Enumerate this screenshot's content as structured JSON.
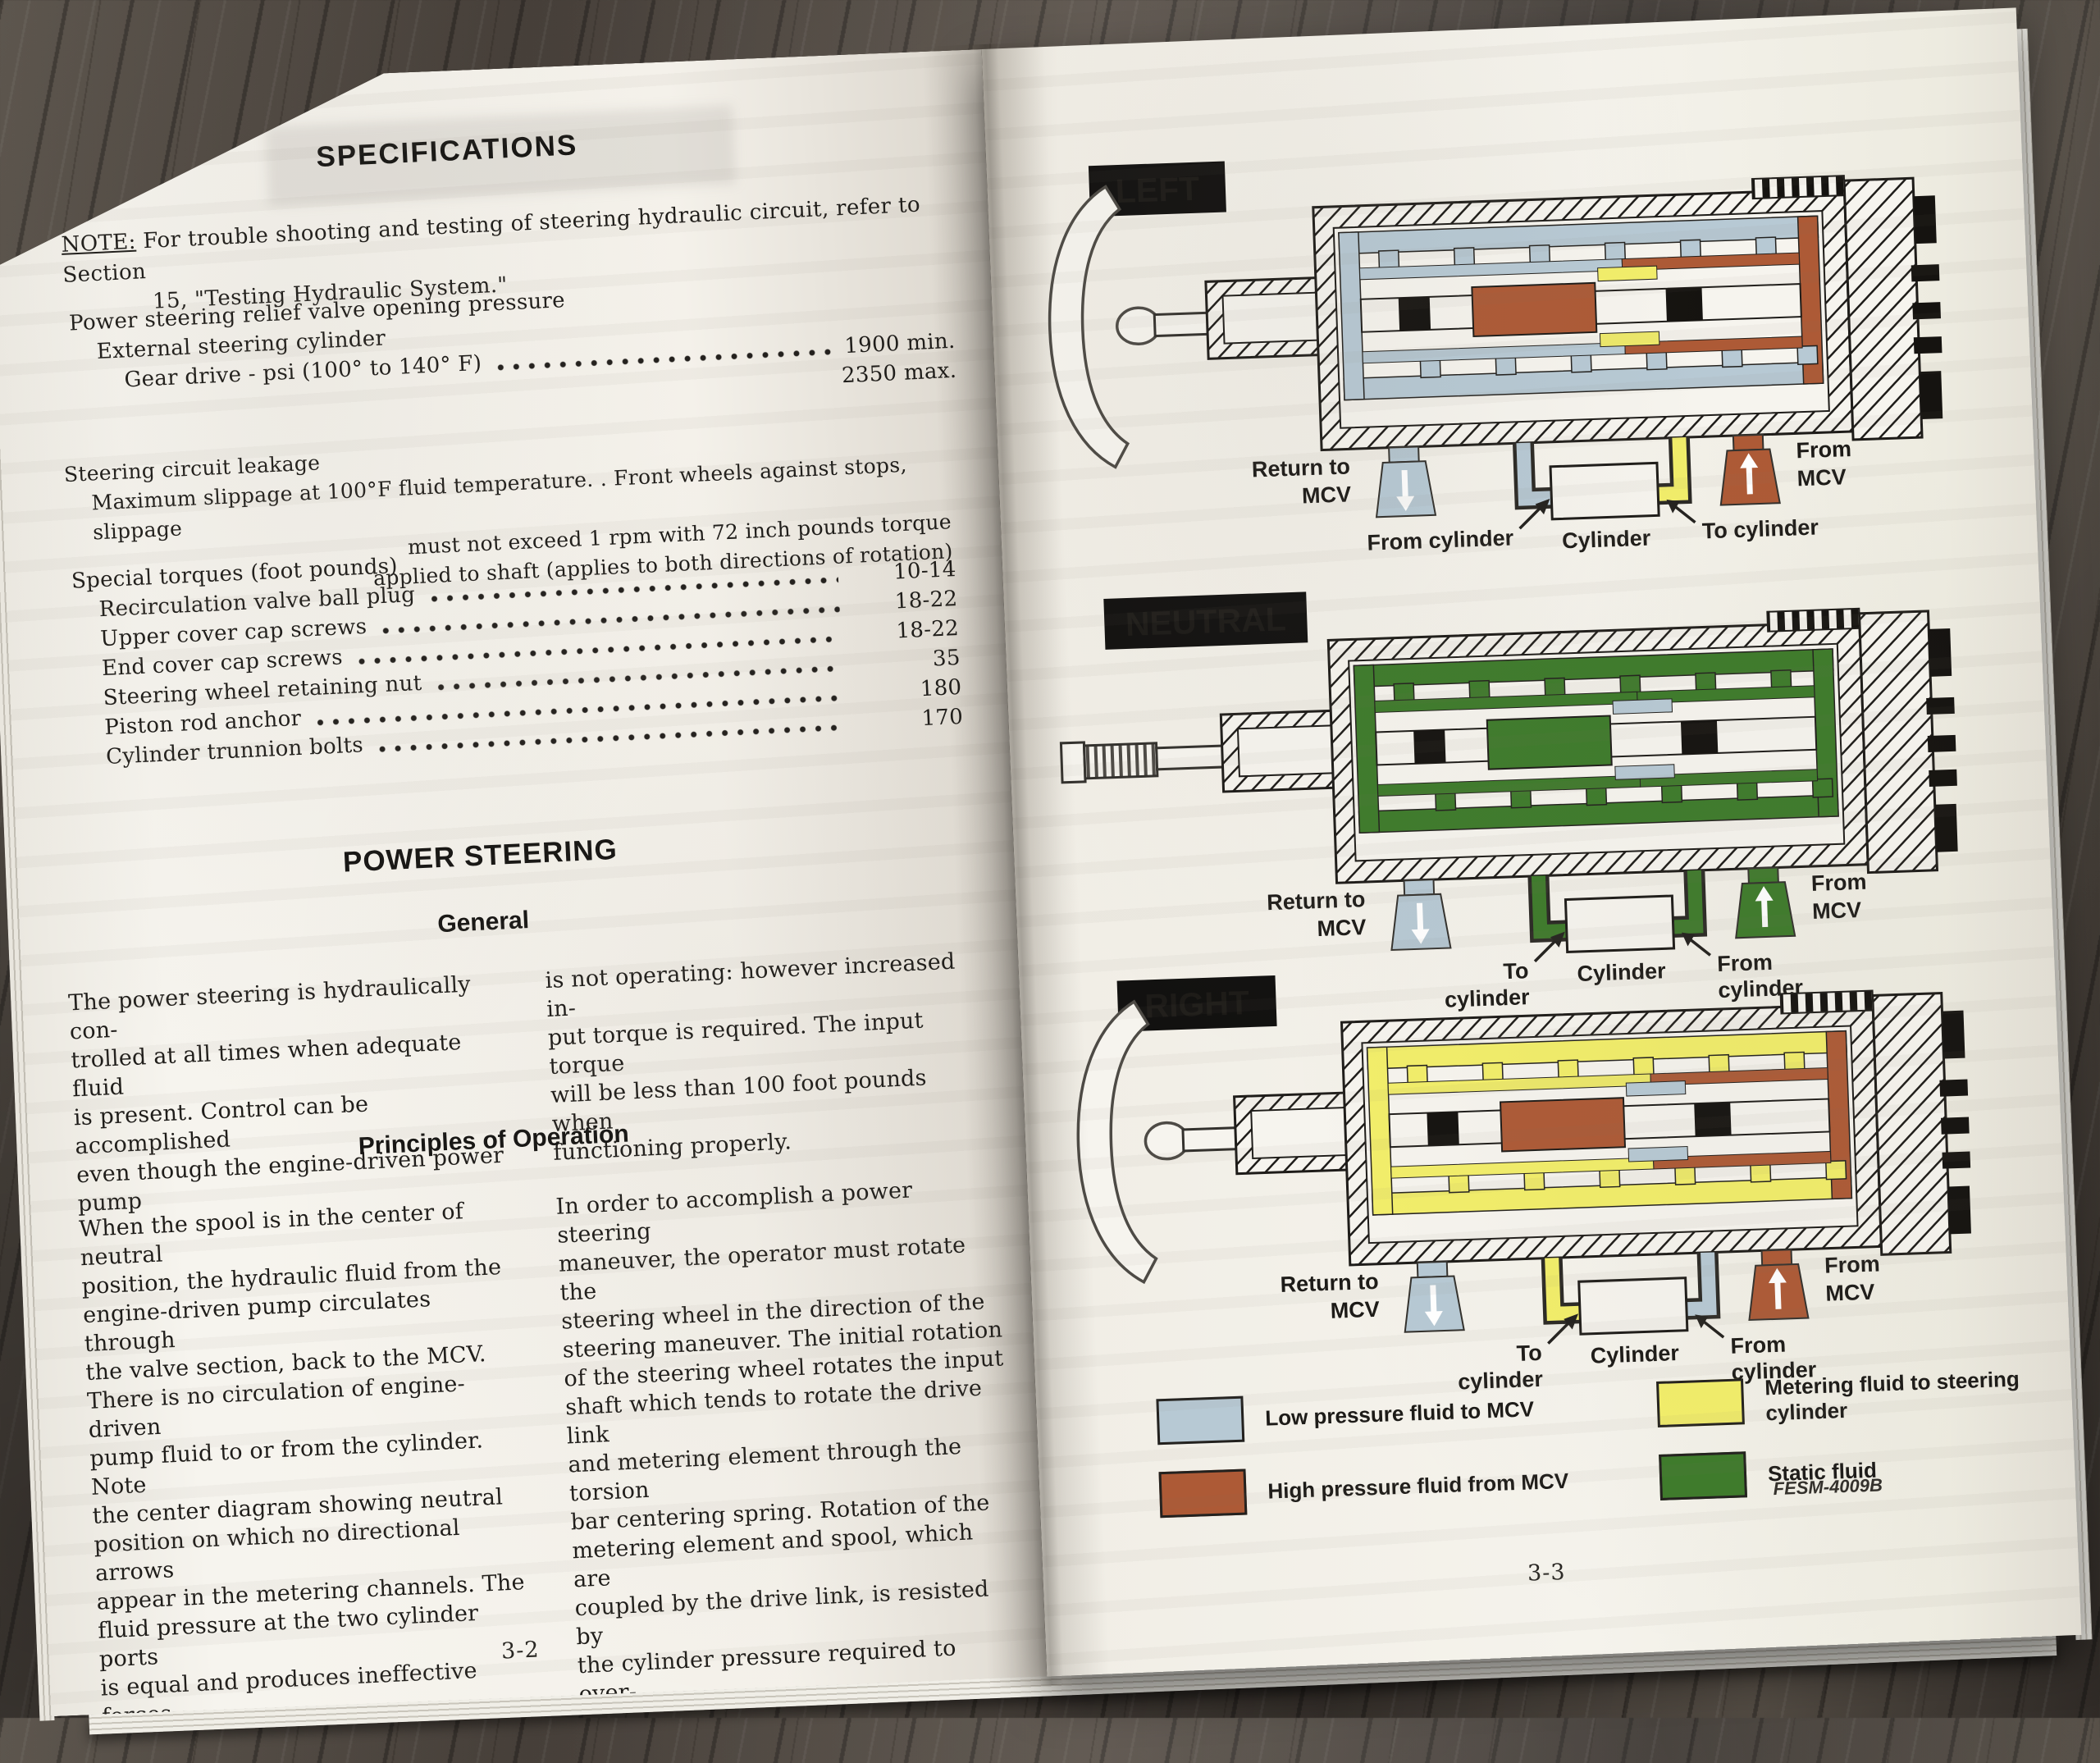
{
  "left_page": {
    "title": "SPECIFICATIONS",
    "note": {
      "label": "NOTE:",
      "line1": "For trouble shooting and testing of steering hydraulic circuit, refer to Section",
      "line2": "15, \"Testing Hydraulic System.\""
    },
    "pressure": {
      "heading": "Power steering relief valve opening pressure",
      "sub": "External steering cylinder",
      "item": "Gear drive - psi (100° to 140° F)",
      "value1": "1900 min.",
      "value2": "2350 max."
    },
    "leakage": {
      "heading": "Steering circuit leakage",
      "line1": "Maximum slippage at 100°F fluid temperature. .  Front wheels against stops, slippage",
      "line2": "must not exceed 1 rpm with 72 inch pounds torque",
      "line3": "applied to shaft (applies to both directions of rotation)"
    },
    "torques": {
      "heading": "Special torques (foot pounds)",
      "items": [
        {
          "label": "Recirculation valve ball plug",
          "value": "10-14"
        },
        {
          "label": "Upper cover cap screws",
          "value": "18-22"
        },
        {
          "label": "End cover cap screws",
          "value": "18-22"
        },
        {
          "label": "Steering wheel retaining nut",
          "value": "35"
        },
        {
          "label": "Piston rod anchor",
          "value": "180"
        },
        {
          "label": "Cylinder trunnion bolts",
          "value": "170"
        }
      ]
    },
    "section_heading": "POWER STEERING",
    "general_heading": "General",
    "general_col1": "The power steering is hydraulically con-\ntrolled at all times when adequate fluid\nis present.  Control can be accomplished\neven though the engine-driven power pump",
    "general_col2": "is not operating:  however increased in-\nput torque is required.  The input torque\nwill be less than 100 foot pounds when\nfunctioning properly.",
    "principles_heading": "Principles of Operation",
    "principles_col1": "When the spool is in the center of neutral\nposition, the hydraulic fluid from the\nengine-driven pump circulates through\nthe valve section, back to the MCV.\nThere is no circulation of engine-driven\npump fluid to or from the cylinder.  Note\nthe center diagram showing neutral\nposition on which no directional arrows\nappear in the metering channels.  The\nfluid pressure at the two cylinder ports\nis equal and produces ineffective forces\nin the cylinder.",
    "principles_col2": "In order to accomplish a power steering\nmaneuver, the operator must rotate the\nsteering wheel in the direction of the\nsteering maneuver.  The initial rotation\nof the steering wheel rotates the input\nshaft which tends to rotate the drive link\nand metering element through the torsion\nbar centering spring.  Rotation of the\nmetering element and spool, which are\ncoupled by the drive link, is resisted by\nthe cylinder pressure required to over-\ncome the steering forces.",
    "page_number": "3-2"
  },
  "right_page": {
    "diagrams": [
      {
        "label": "LEFT",
        "input": "wheel",
        "port_left": "Return to\nMCV",
        "port_right": "From\nMCV",
        "pipe_left": "From  cylinder",
        "cylinder": "Cylinder",
        "pipe_right": "To cylinder",
        "colors": {
          "a": "#b7c9d4",
          "b": "#ad5a36",
          "c": "#f2ee6a",
          "spoutL": "#b7c9d4",
          "spoutR": "#ad5a36",
          "pipeL": "#b7c9d4",
          "pipeR": "#f2ee6a"
        }
      },
      {
        "label": "NEUTRAL",
        "input": "spline",
        "port_left": "Return to\nMCV",
        "port_right": "From\nMCV",
        "pipe_left": "To\ncylinder",
        "cylinder": "Cylinder",
        "pipe_right": "From\ncylinder",
        "colors": {
          "a": "#3e7b2b",
          "b": "#3e7b2b",
          "c": "#b7c9d4",
          "spoutL": "#b7c9d4",
          "spoutR": "#3e7b2b",
          "pipeL": "#3e7b2b",
          "pipeR": "#3e7b2b"
        }
      },
      {
        "label": "RIGHT",
        "input": "wheel",
        "port_left": "Return to\nMCV",
        "port_right": "From\nMCV",
        "pipe_left": "To\ncylinder",
        "cylinder": "Cylinder",
        "pipe_right": "From\ncylinder",
        "colors": {
          "a": "#f2ee6a",
          "b": "#ad5a36",
          "c": "#b7c9d4",
          "spoutL": "#b7c9d4",
          "spoutR": "#ad5a36",
          "pipeL": "#f2ee6a",
          "pipeR": "#b7c9d4"
        }
      }
    ],
    "legend": {
      "items": [
        {
          "color": "#b7c9d4",
          "label": "Low pressure fluid to MCV"
        },
        {
          "color": "#ad5a36",
          "label": "High pressure fluid from MCV"
        },
        {
          "color": "#f2ee6a",
          "label": "Metering fluid to steering cylinder"
        },
        {
          "color": "#3e7b2b",
          "label": "Static fluid"
        }
      ],
      "code": "FESM-4009B"
    },
    "page_number": "3-3"
  }
}
